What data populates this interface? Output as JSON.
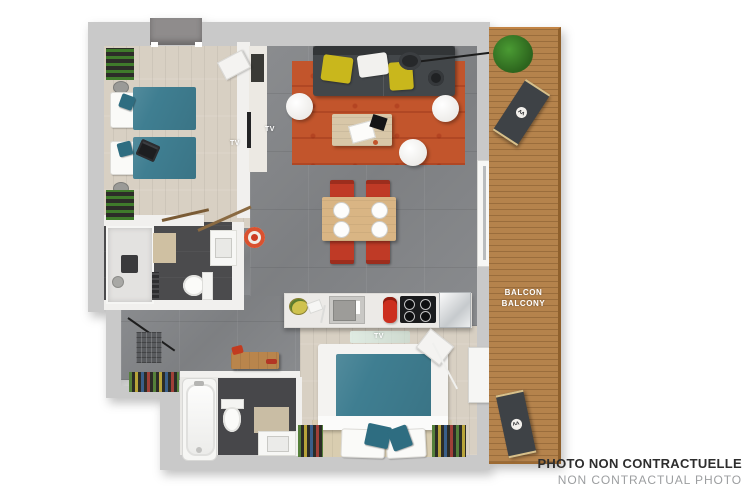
{
  "labels": {
    "tv_bedroom1": "TV",
    "tv_living": "TV",
    "tv_bedroom2": "TV",
    "balcony_fr": "BALCON",
    "balcony_en": "BALCONY",
    "disclaimer_fr": "PHOTO NON CONTRACTUELLE",
    "disclaimer_en": "NON CONTRACTUAL PHOTO"
  },
  "colors": {
    "wall_gray": "#c9c9c9",
    "wood_floor": "#d8d0c3",
    "tile_floor": "#85878a",
    "dark_bath_floor": "#4b4b4d",
    "balcony_deck": "#b5834c",
    "bed_teal": "#3f7e91",
    "rug_orange": "#c2552c",
    "sofa_gray": "#43474a",
    "chair_red": "#bf3a26",
    "pillow_yellow": "#c9b71c",
    "disclaimer_bold": "#2d2d2d",
    "disclaimer_gray": "#9c9ea0"
  }
}
